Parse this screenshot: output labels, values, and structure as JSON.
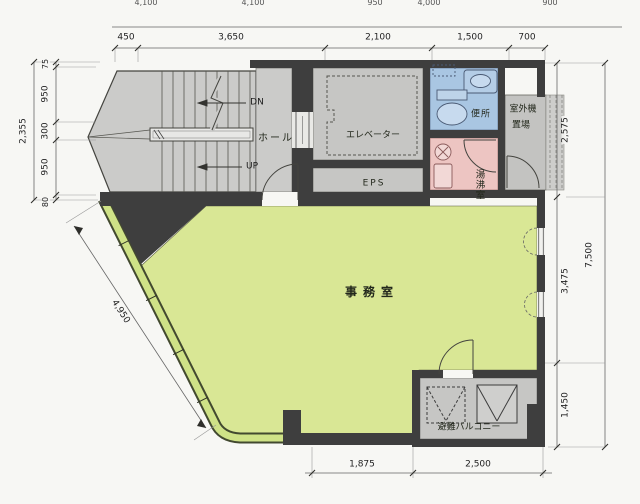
{
  "drawing": {
    "type": "architectural floor plan"
  },
  "rooms": {
    "hall": "ホール",
    "elevator": "エレベーター",
    "eps": "EPS",
    "toilet": "便所",
    "outdoor_unit": [
      "室外機",
      "置場"
    ],
    "kitchenette": "湯沸室",
    "office": "事務室",
    "balcony": "避難バルコニー"
  },
  "stairs": {
    "down": "DN",
    "up": "UP"
  },
  "dimensions": {
    "top_upper": [
      "4,100",
      "4,100",
      "950",
      "4,000",
      "900"
    ],
    "top": [
      "450",
      "3,650",
      "2,100",
      "1,500",
      "700"
    ],
    "left_total": "2,355",
    "left": [
      "75",
      "950",
      "300",
      "950",
      "80"
    ],
    "right": [
      "2,575",
      "3,475",
      "1,450"
    ],
    "right_total": "7,500",
    "bottom": [
      "1,875",
      "2,500"
    ],
    "diagonal": "4,950"
  },
  "colors": {
    "wall": "#3e3e3e",
    "office_floor": "#d9e795",
    "common_floor": "#c8c8c6",
    "toilet_blue": "#a9c6e2",
    "kitchenette_pink": "#edc5c2",
    "window_band": "#cfe287",
    "background": "#f7f7f4"
  }
}
